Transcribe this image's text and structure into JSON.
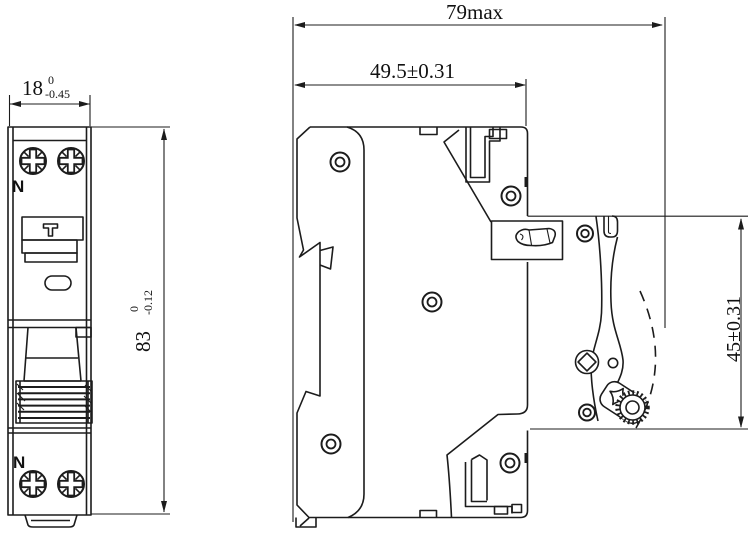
{
  "front_view": {
    "width_dimension": {
      "nominal": "18",
      "upper_tolerance": "0",
      "lower_tolerance": "-0.45"
    },
    "height_dimension": {
      "nominal": "83",
      "upper_tolerance": "0",
      "lower_tolerance": "-0.12"
    },
    "top_terminal_label": "N",
    "bottom_terminal_label": "N"
  },
  "side_view": {
    "overall_depth_dimension": "79max",
    "body_depth_dimension": "49.5±0.31",
    "rail_height_dimension": "45±0.31"
  },
  "colors": {
    "line": "#1c1c1c",
    "background": "#ffffff"
  }
}
